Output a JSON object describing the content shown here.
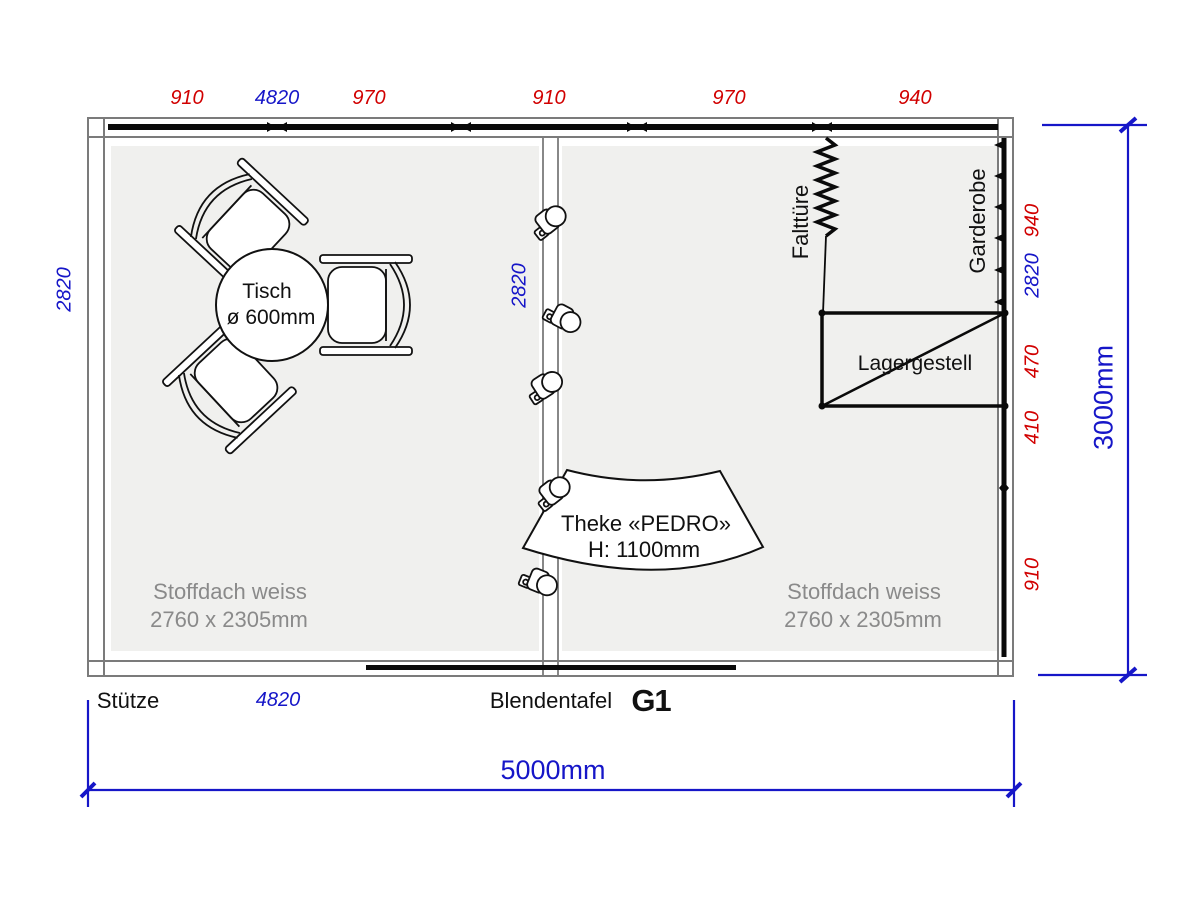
{
  "drawing": {
    "booth_panel_id": "G1",
    "colors": {
      "dimension_red": "#d10000",
      "dimension_blue": "#1616c8",
      "roof_text_gray": "#8a8a8a",
      "frame_gray": "#7b7b7b",
      "panel_fill": "#f0f0ee"
    }
  },
  "dimensions": {
    "top_segments": [
      "910",
      "970",
      "910",
      "970",
      "940"
    ],
    "top_overall_inner": "4820",
    "right_segments": [
      "940",
      "470",
      "410",
      "910"
    ],
    "right_overall_inner": "2820",
    "left_depth": "2820",
    "center_depth": "2820",
    "overall_width": "5000mm",
    "overall_depth": "3000mm",
    "front_inner_width": "4820"
  },
  "annotations": {
    "support": "Stütze",
    "fascia_board": "Blendentafel",
    "folding_door": "Falttüre",
    "wardrobe": "Garderobe",
    "storage_rack": "Lagergestell",
    "roof_left": {
      "line1": "Stoffdach weiss",
      "line2": "2760 x 2305mm"
    },
    "roof_right": {
      "line1": "Stoffdach weiss",
      "line2": "2760 x 2305mm"
    },
    "table": {
      "line1": "Tisch",
      "line2": "ø 600mm"
    },
    "counter": {
      "line1": "Theke «PEDRO»",
      "line2": "H: 1100mm"
    }
  }
}
